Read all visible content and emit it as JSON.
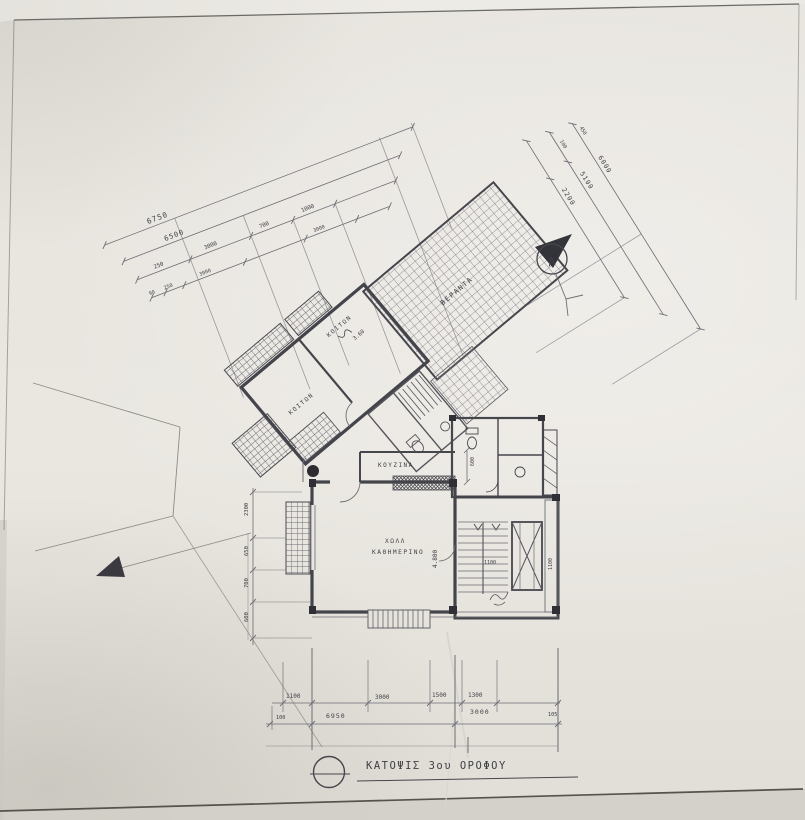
{
  "drawing": {
    "title": "ΚΑΤΟΨΙΣ  3ου  ΟΡΟΦΟΥ",
    "north_letter": "A"
  },
  "rooms": {
    "bedroom_left": "ΚΟΙΤΩΝ",
    "bedroom_right": "ΚΟΙΤΩΝ",
    "bedroom_right_dim": "3.60",
    "veranda": "ΒΕΡΑΝΤΑ",
    "hall_line1": "ΧΩΛΛ",
    "hall_line2": "ΚΑΘΗΜΕΡΙΝΟ",
    "hall_dim": "4.800",
    "kitchen": "ΚΟΥΖΙΝΑ",
    "stair_left_dim": "1100",
    "stair_right_dim": "1100"
  },
  "dimensions": {
    "upper_left": {
      "total": "6750",
      "sub_total": "6500",
      "row3": [
        "250",
        "3000",
        "700",
        "1000"
      ],
      "row4": [
        "90",
        "250",
        "3000",
        "3000"
      ]
    },
    "right": {
      "outer": "6000",
      "middle": "5100",
      "inner": "2200",
      "small_a": "450",
      "small_b": "100"
    },
    "bottom": {
      "row1": [
        "1100",
        "3000",
        "1500",
        "1300"
      ],
      "row2": [
        "100",
        "6950",
        "3000",
        "105"
      ]
    },
    "left": [
      "2300",
      "650",
      "700",
      "600"
    ],
    "kitchen_side": "600"
  },
  "colors": {
    "paper": "#e9e6e0",
    "ink": "#3f3f46",
    "wall": "#44444b",
    "thin_line": "#6d6d74"
  }
}
